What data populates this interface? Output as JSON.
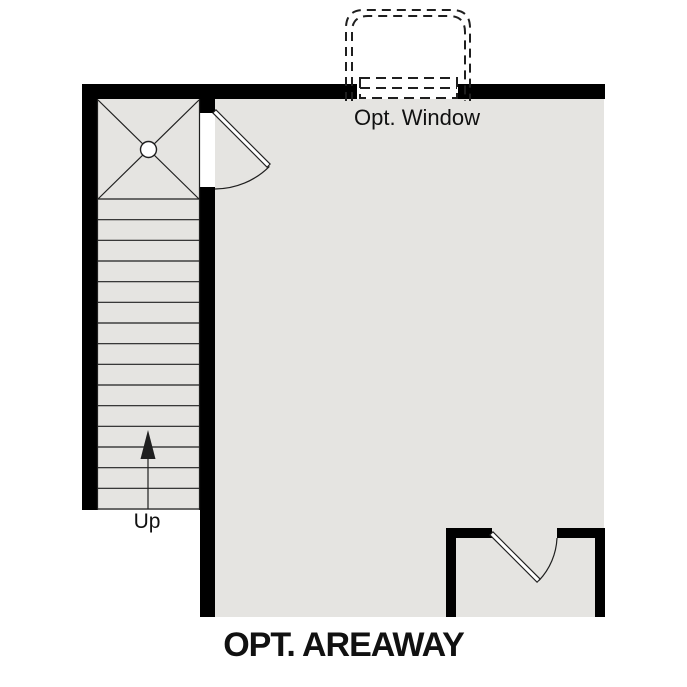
{
  "floor_plan": {
    "title": "OPT. AREAWAY",
    "labels": {
      "window": "Opt. Window",
      "stairs_direction": "Up"
    },
    "stairs": {
      "treads": 15
    },
    "colors": {
      "wall": "#000000",
      "floor": "#e5e4e1",
      "line": "#1f1f1f",
      "text": "#111111",
      "background": "#ffffff"
    }
  }
}
